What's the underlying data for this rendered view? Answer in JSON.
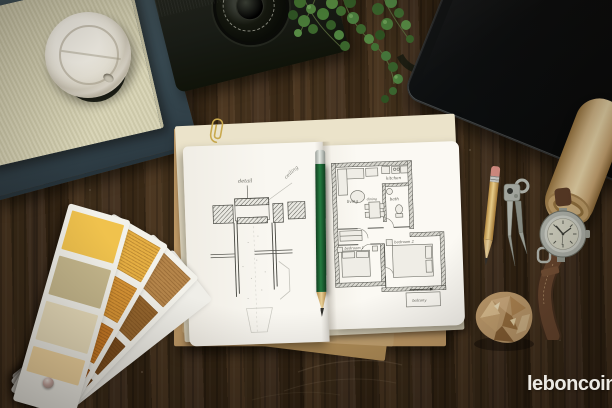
{
  "watermark": {
    "text": "leboncoin",
    "color": "#eceae4"
  },
  "floor_plan": {
    "labels": {
      "living": "living",
      "kitchen": "kitchen",
      "bath": "bath",
      "dining": "dining",
      "bedroom1": "bedroom 1",
      "bedroom2": "bedroom 2",
      "balcony": "balcony"
    }
  },
  "detail_sketch": {
    "labels": {
      "callout": "detail",
      "diagonal": "ceiling"
    }
  },
  "palette": {
    "wood_base": "#3a2a1a",
    "tablet_black": "#0b0d0e",
    "notebook_page": "#f7f5ef",
    "kraft_paper": "#c49e6a",
    "green_pencil": "#1e5c31",
    "watch_strap_brown": "#64422c",
    "watermark_white": "#eceae4"
  },
  "swatch_fan": {
    "cards": [
      {
        "name": "front-card",
        "colors": [
          "#f0c24d",
          "#c6b88d",
          "#ebdfbd",
          "#f3d7a1"
        ]
      },
      {
        "name": "amber-card",
        "colors": [
          "#e5ae42",
          "#d89434",
          "#c87a26",
          "#a85e1e"
        ]
      },
      {
        "name": "brown-card",
        "colors": [
          "#b5854a",
          "#96662e",
          "#7d4e1e",
          "#6b3f16"
        ]
      },
      {
        "name": "hidden-card",
        "colors": [
          "#efeee8",
          "#efeee8",
          "#efeee8",
          "#efeee8"
        ]
      }
    ]
  }
}
